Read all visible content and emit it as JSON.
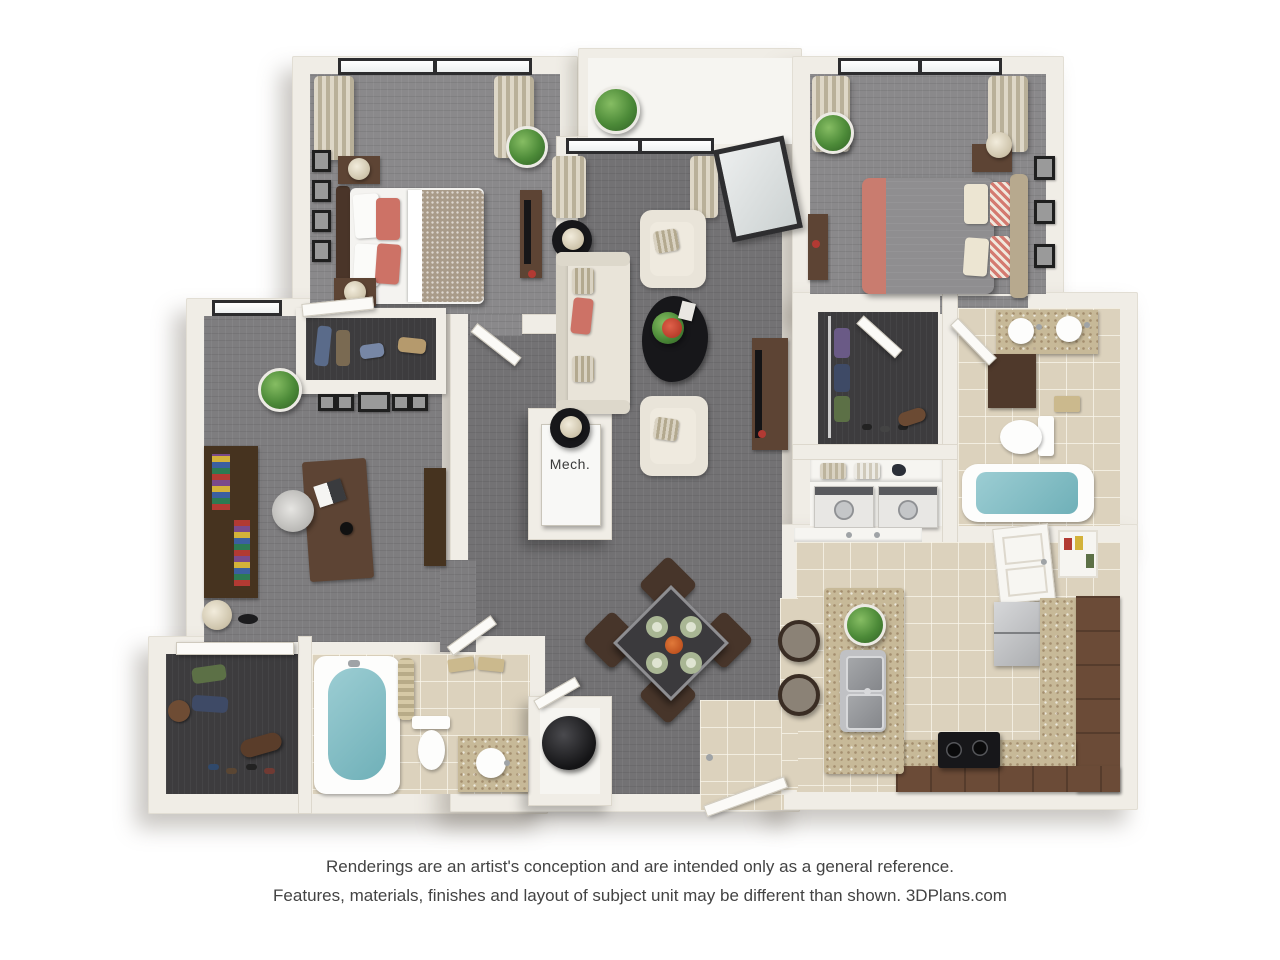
{
  "plan": {
    "mech_label": "Mech.",
    "colors": {
      "background": "#ffffff",
      "wall": "#f0ede6",
      "carpet_living": "#737274",
      "carpet_bedroom": "#8a898b",
      "closet_floor": "#3d3c3e",
      "tile": "#dcd2bd",
      "cabinet_wood": "#5d4434",
      "granite_counter": "#c7b998",
      "accent_coral": "#cd7266",
      "bath_water": "#84c0c8",
      "plant_green": "#4c8a38",
      "appliance_stainless": "#b9bbbe",
      "tv_black": "#17171a"
    }
  },
  "disclaimer": {
    "line1": "Renderings are an artist's conception and are intended only as a general reference.",
    "line2": "Features, materials, finishes and layout of subject unit may be different than shown. 3DPlans.com"
  }
}
